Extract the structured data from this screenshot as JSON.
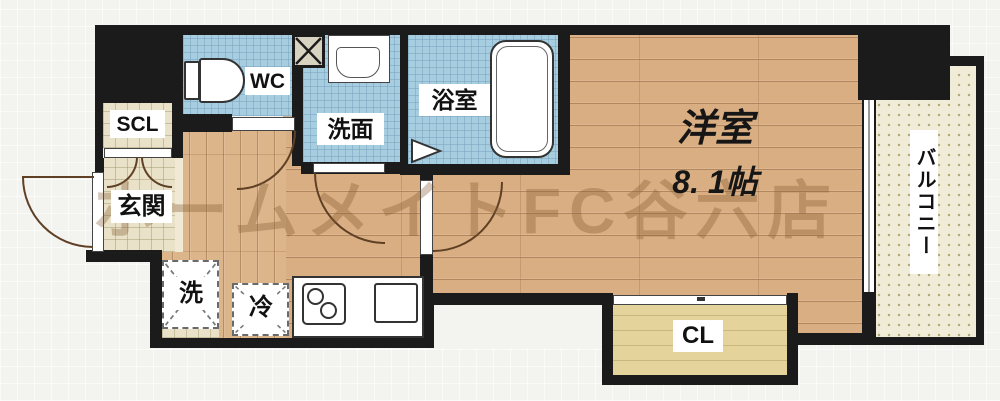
{
  "watermark": "ホームメイトFC谷六店",
  "rooms": {
    "wc": {
      "label": "WC"
    },
    "scl": {
      "label": "SCL"
    },
    "genkan": {
      "label": "玄関"
    },
    "senmen": {
      "label": "洗面"
    },
    "bath": {
      "label": "浴室"
    },
    "western": {
      "label": "洋室",
      "size": "8. 1帖"
    },
    "closet": {
      "label": "CL"
    },
    "balcony": {
      "label": "バルコニー"
    },
    "washer": {
      "label": "洗"
    },
    "fridge": {
      "label": "冷"
    }
  },
  "fixtures": {
    "toilet": "css-shape",
    "wash-basin": "css-shape",
    "bathtub": "css-shape",
    "bath-door": "svg-triangle",
    "pipe-shaft": "svg-x",
    "washer-space-mark": "svg-dashed-x",
    "fridge-space-mark": "svg-dashed-x",
    "stove-burners": "css-circles",
    "kitchen-sink": "css-rect",
    "entrance-door": "arc",
    "room-door": "arc",
    "sliding-window": "double-line"
  },
  "colors": {
    "wall": "#1b1b1b",
    "wood_floor": "#d9ae82",
    "wet_area_tile": "#a7cde0",
    "entry_tile": "#e9e2c8",
    "closet_floor": "#e4d49c",
    "balcony_floor": "#f1ecd8",
    "door_arc": "#5f4025",
    "label_text": "#111111",
    "watermark_tint": "#805830"
  }
}
